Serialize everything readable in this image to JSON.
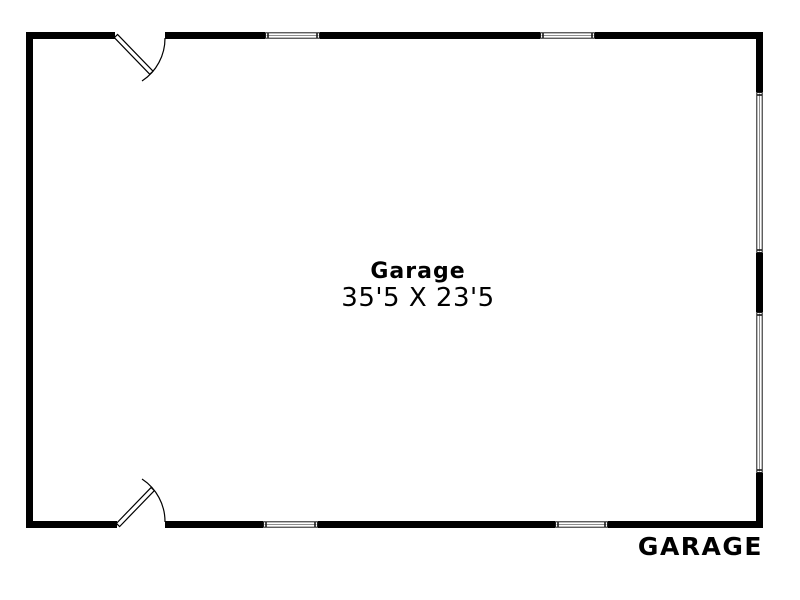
{
  "floorplan": {
    "room": {
      "name": "Garage",
      "dimensions": "35'5 X 23'5"
    },
    "plan_label": "GARAGE",
    "colors": {
      "wall": "#000000",
      "text": "#000000",
      "window_frame": "#1a1a1a",
      "window_glass": "#ffffff",
      "window_midline": "#8f8f8f",
      "background": "#ffffff"
    },
    "features": {
      "door_count": 2,
      "window_count": 6,
      "doors": [
        "top-left-swing-door",
        "bottom-left-swing-door"
      ],
      "windows": [
        "top-wall-window-1",
        "top-wall-window-2",
        "bottom-wall-window-1",
        "bottom-wall-window-2",
        "right-wall-window-1",
        "right-wall-window-2"
      ]
    }
  }
}
